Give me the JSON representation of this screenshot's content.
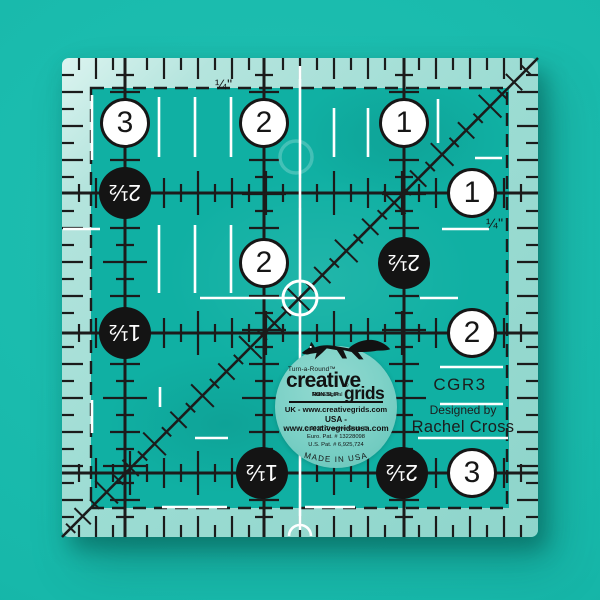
{
  "product": {
    "model": "CGR3",
    "designed_by_label": "Designed by",
    "designer": "Rachel Cross",
    "quarter_inch_label": "¼\"",
    "logo": {
      "turnaround": "Turn-a-Round™",
      "brand_line1": "creative",
      "brand_line2": "grids",
      "registered": "®",
      "tagline_pre": "The Original ",
      "tagline_bold": "NON-SLIP",
      "tagline_post": " Ruler",
      "uk_line": "UK - www.creativegrids.com",
      "usa_line": "USA - www.creativegridsusa.com",
      "copyright_line": "© 2015  Creative Grids ®",
      "euro_patent": "Euro. Pat. # 13228098",
      "us_patent": "U.S. Pat. # 6,925,724",
      "made_in": "MADE IN USA"
    }
  },
  "ruler": {
    "circles": [
      {
        "x": 125,
        "y": 123,
        "style": "white",
        "label": "3"
      },
      {
        "x": 264,
        "y": 123,
        "style": "white",
        "label": "2"
      },
      {
        "x": 404,
        "y": 123,
        "style": "white",
        "label": "1"
      },
      {
        "x": 125,
        "y": 193,
        "style": "black",
        "label": "2½"
      },
      {
        "x": 472,
        "y": 193,
        "style": "white",
        "label": "1"
      },
      {
        "x": 264,
        "y": 263,
        "style": "white",
        "label": "2"
      },
      {
        "x": 404,
        "y": 263,
        "style": "black",
        "label": "2½"
      },
      {
        "x": 125,
        "y": 333,
        "style": "black",
        "label": "1½"
      },
      {
        "x": 472,
        "y": 333,
        "style": "white",
        "label": "2"
      },
      {
        "x": 262,
        "y": 473,
        "style": "black",
        "label": "1½"
      },
      {
        "x": 402,
        "y": 473,
        "style": "black",
        "label": "2½"
      },
      {
        "x": 472,
        "y": 473,
        "style": "white",
        "label": "3"
      }
    ]
  },
  "colors": {
    "background": "#17b8aa",
    "ruler_interior": "#10b0a3",
    "frosted_edge": "#9cdcd3",
    "line_black": "#1b1b1b",
    "mark_white": "#ffffff",
    "logo_disc": "#7fd2c8"
  }
}
